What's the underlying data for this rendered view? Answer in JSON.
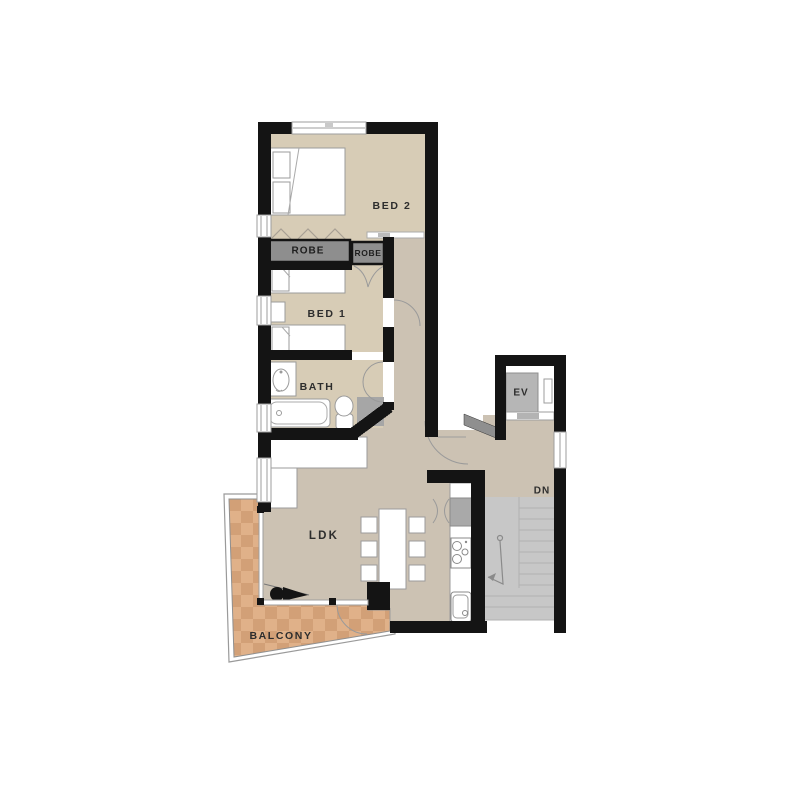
{
  "plan": {
    "rooms": {
      "bed2": {
        "label": "BED 2"
      },
      "bed1": {
        "label": "BED 1"
      },
      "bath": {
        "label": "BATH"
      },
      "ldk": {
        "label": "LDK"
      },
      "balcony": {
        "label": "BALCONY"
      },
      "elevator": {
        "label": "EV"
      },
      "stairs_down": {
        "label": "DN"
      },
      "robe_left": {
        "label": "ROBE"
      },
      "robe_right": {
        "label": "ROBE"
      }
    },
    "icons": {
      "double_bed": "double-bed",
      "single_beds": "twin-beds",
      "bathtub": "bathtub",
      "toilet": "toilet",
      "basin": "wash-basin",
      "sofa": "l-shaped-sofa",
      "dining_table": "dining-table-6-chairs",
      "cooktop": "cooktop",
      "kitchen_sink": "kitchen-sink",
      "fridge": "refrigerator",
      "telescope": "telescope",
      "stairs": "staircase-down-arrow"
    },
    "colors": {
      "wall": "#141414",
      "bedroom_floor": "#d7ccb6",
      "hall_floor": "#ccc2b3",
      "balcony_tile_light": "#e0b189",
      "balcony_tile_dark": "#d2a077",
      "stairs": "#c7c7c7",
      "robe_fill": "#8e8e8e",
      "shower_fill": "#a6a6a6",
      "elevator_car": "#b6b6b6",
      "fridge_fill": "#a9a9a9",
      "door_leaf": "#8f8f8f",
      "furniture_outline": "#9b9b9b",
      "label_text": "#2d2d2d"
    }
  }
}
